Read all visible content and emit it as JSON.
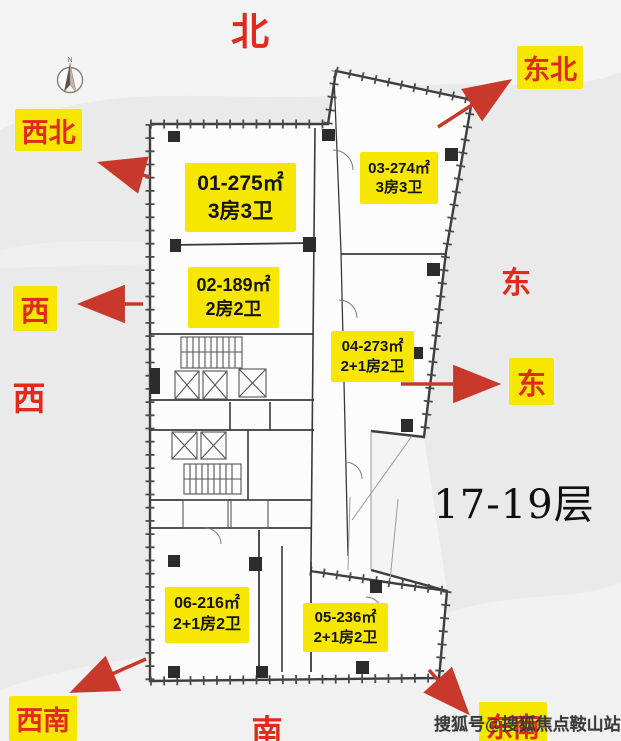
{
  "compass": {
    "letter": "N"
  },
  "directions": {
    "north": "北",
    "northeast": "东北",
    "northwest": "西北",
    "west_boxed": "西",
    "west_plain": "西",
    "east_plain": "东",
    "east_boxed": "东",
    "southwest": "西南",
    "south": "南",
    "southeast": "东南"
  },
  "units": [
    {
      "code": "01",
      "area": "01-275㎡",
      "layout": "3房3卫"
    },
    {
      "code": "02",
      "area": "02-189㎡",
      "layout": "2房2卫"
    },
    {
      "code": "03",
      "area": "03-274㎡",
      "layout": "3房3卫"
    },
    {
      "code": "04",
      "area": "04-273㎡",
      "layout": "2+1房2卫"
    },
    {
      "code": "05",
      "area": "05-236㎡",
      "layout": "2+1房2卫"
    },
    {
      "code": "06",
      "area": "06-216㎡",
      "layout": "2+1房2卫"
    }
  ],
  "floor_range": "17-19层",
  "watermark": "搜狐号@搜狐焦点鞍山站",
  "colors": {
    "label_bg": "#F7E600",
    "direction_red": "#E02A1C",
    "arrow_red": "#C8392B",
    "wall_gray": "#3E3E3E",
    "background": "#EAEAEA",
    "floor_text": "#101010",
    "watermark_text": "#3A3A3A"
  }
}
